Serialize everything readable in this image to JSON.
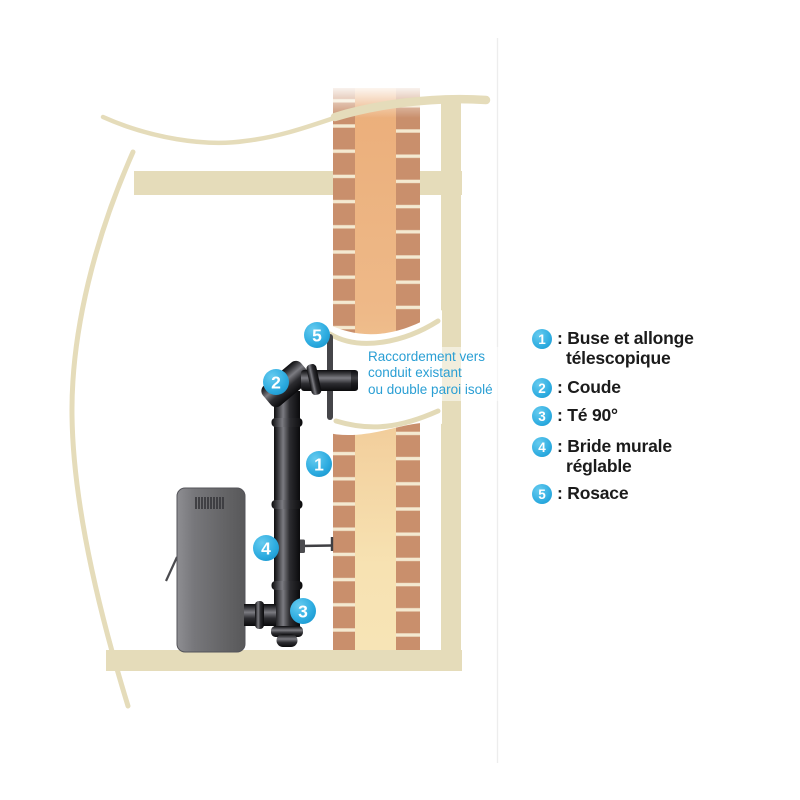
{
  "diagram": {
    "badge_numbers": [
      "1",
      "2",
      "3",
      "4",
      "5"
    ]
  },
  "annotation": {
    "lines": [
      "Raccordement vers",
      "conduit existant",
      "ou double paroi isolé"
    ]
  },
  "legend": {
    "items": [
      {
        "num": "1",
        "line1": ": Buse et allonge",
        "line2": "télescopique"
      },
      {
        "num": "2",
        "line1": ": Coude",
        "line2": ""
      },
      {
        "num": "3",
        "line1": ": Té 90°",
        "line2": ""
      },
      {
        "num": "4",
        "line1": ": Bride murale",
        "line2": "réglable"
      },
      {
        "num": "5",
        "line1": ": Rosace",
        "line2": ""
      }
    ]
  },
  "colors": {
    "badge_blue": "#2fade1",
    "annotation_blue": "#2a9fd4",
    "structure_beige": "#e5dcba",
    "brick": "#c98f6c",
    "mortar": "#f4e9d0",
    "flue_top": "#ebae7a",
    "flue_bottom": "#f7e4b6",
    "stove_gray": "#6c6c6e",
    "pipe_black": "#1a1a1c"
  }
}
